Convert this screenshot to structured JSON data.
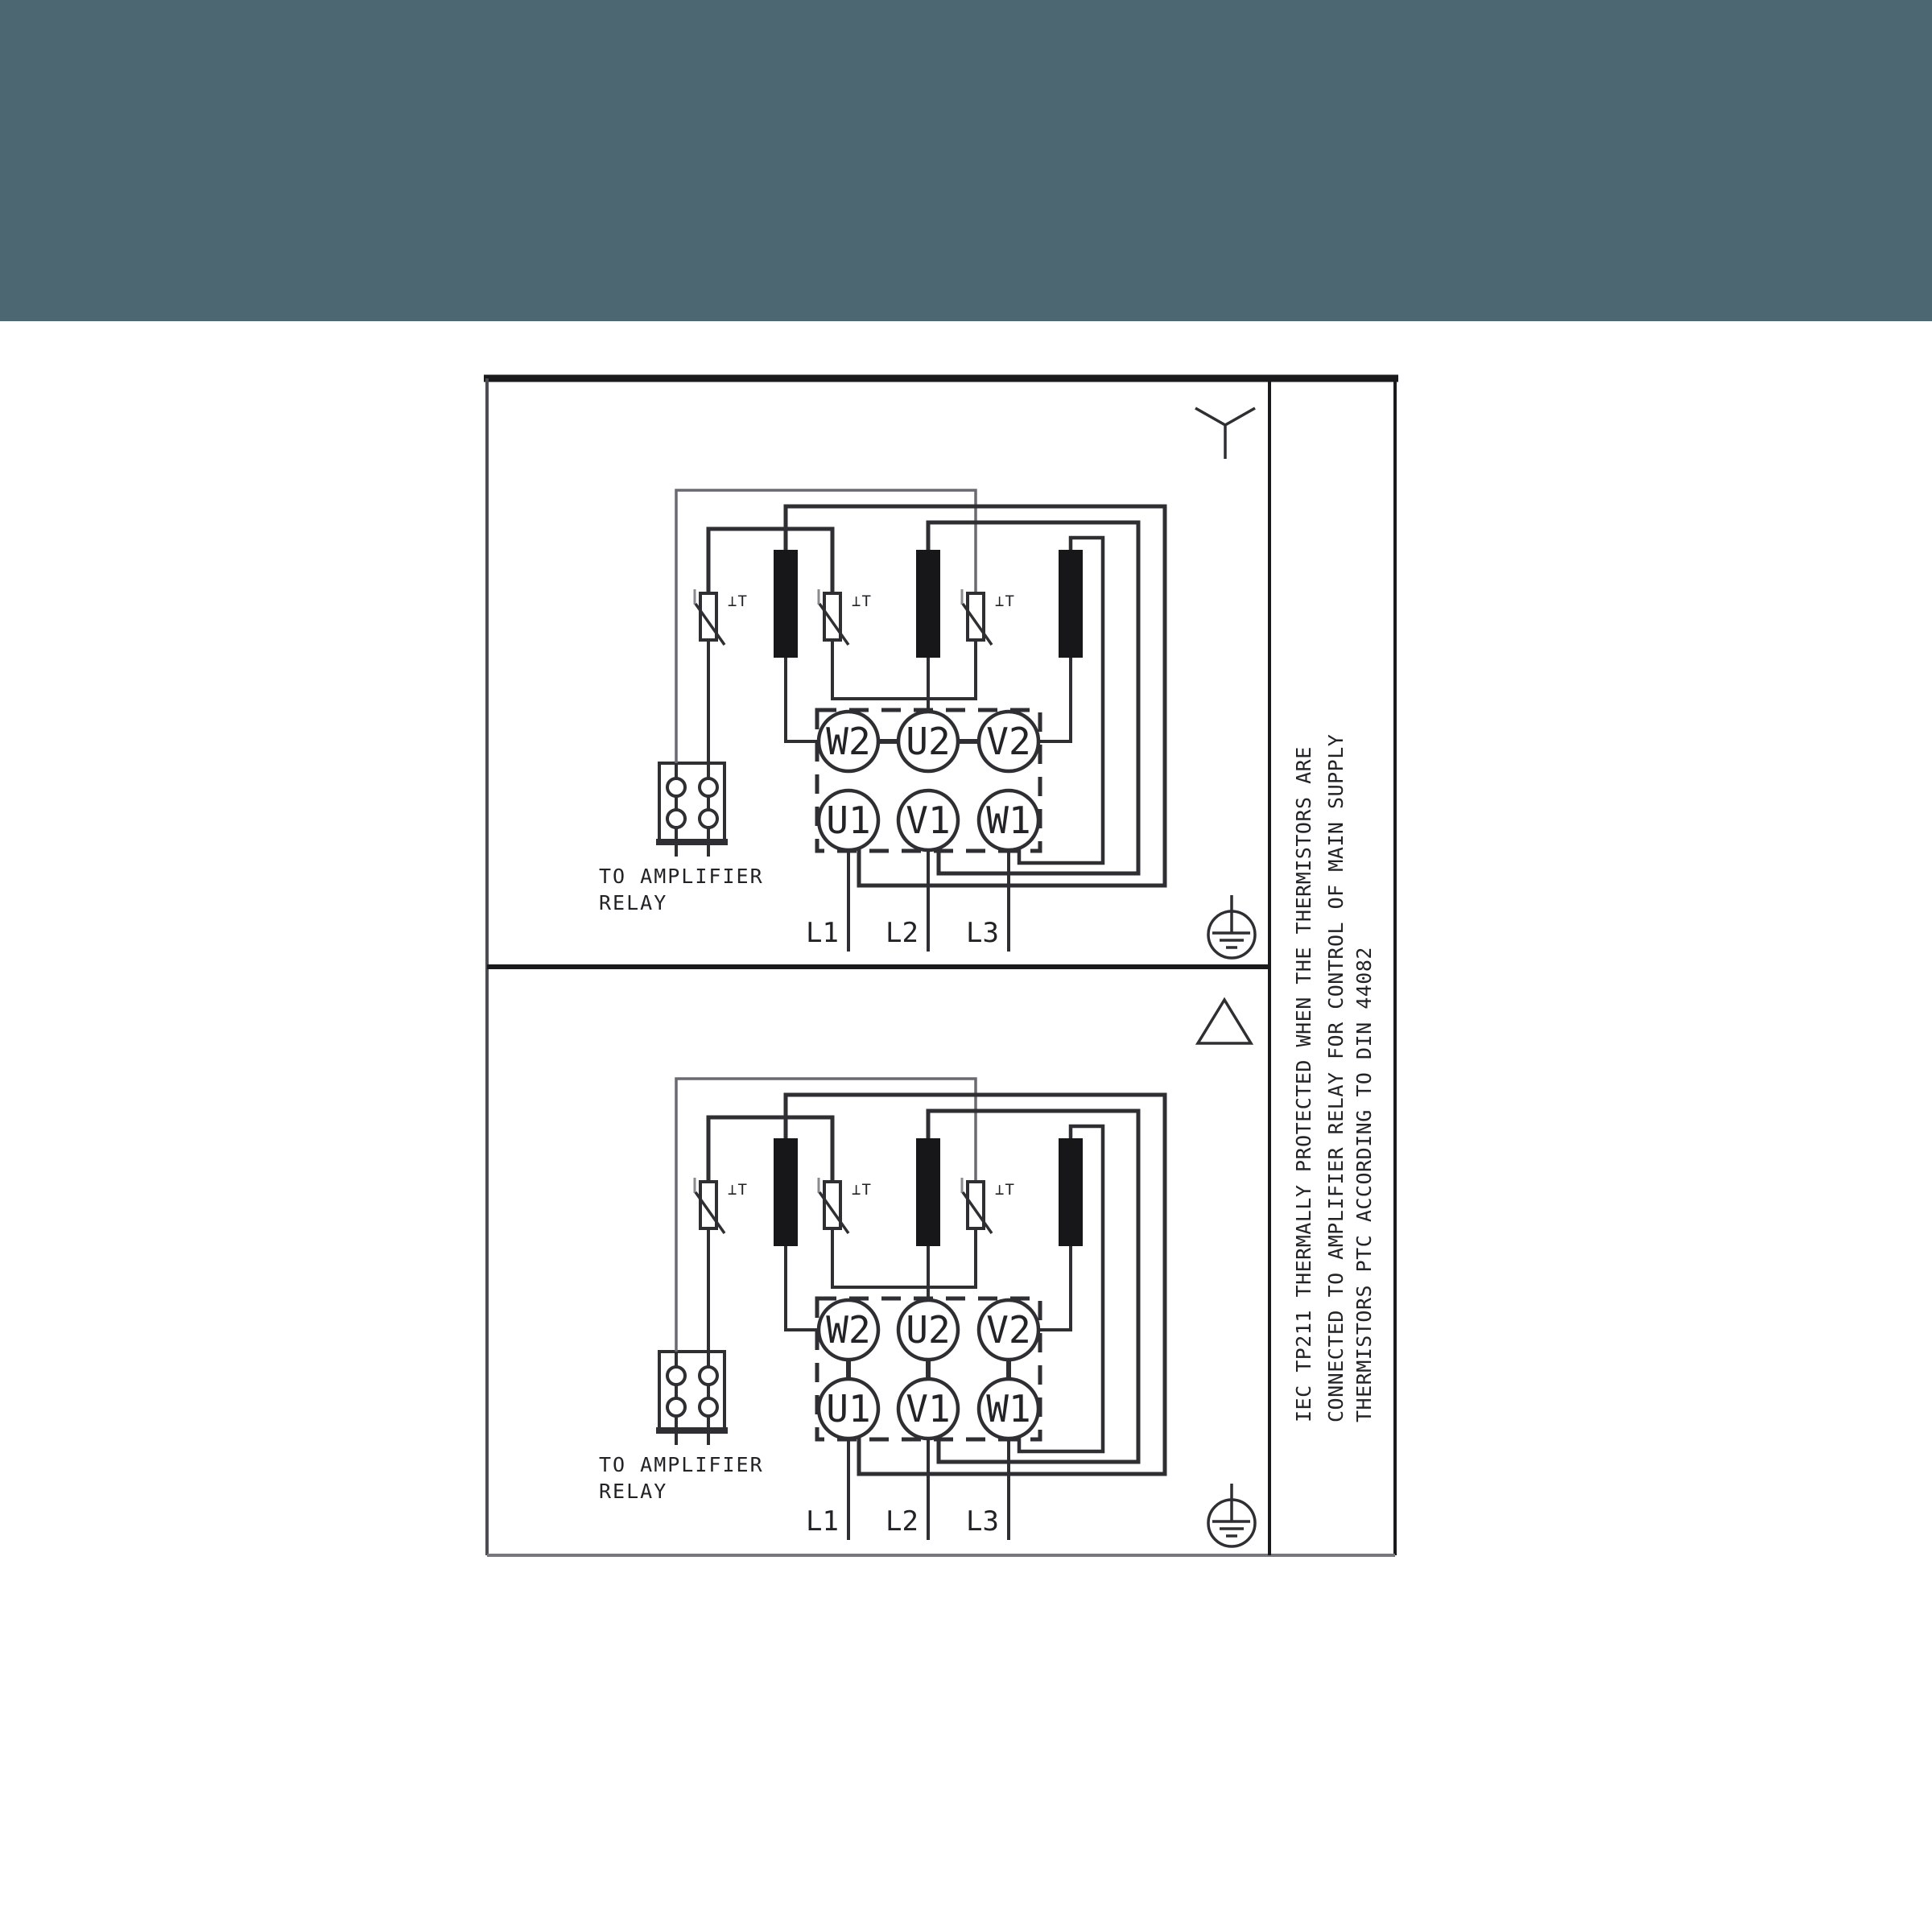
{
  "banner": {
    "background_color": "#4c6771"
  },
  "diagram": {
    "colors": {
      "line": "#2e2e33",
      "thin_line": "#6a6a72",
      "frame": "#1a1a1c",
      "bar_fill": "#17171a",
      "background": "#ffffff"
    },
    "sections": [
      {
        "connection": "star",
        "connection_icon": "star-icon",
        "terminals_top": [
          "W2",
          "U2",
          "V2"
        ],
        "terminals_bottom": [
          "U1",
          "V1",
          "W1"
        ],
        "supply_labels": [
          "L1",
          "L2",
          "L3"
        ],
        "relay_note": [
          "TO AMPLIFIER",
          "RELAY"
        ],
        "thermistor_label": "⊥T"
      },
      {
        "connection": "delta",
        "connection_icon": "delta-icon",
        "terminals_top": [
          "W2",
          "U2",
          "V2"
        ],
        "terminals_bottom": [
          "U1",
          "V1",
          "W1"
        ],
        "supply_labels": [
          "L1",
          "L2",
          "L3"
        ],
        "relay_note": [
          "TO AMPLIFIER",
          "RELAY"
        ],
        "thermistor_label": "⊥T"
      }
    ],
    "side_note_lines": [
      "IEC TP211 THERMALLY PROTECTED WHEN THE THERMISTORS ARE",
      "CONNECTED TO AMPLIFIER RELAY FOR CONTROL OF MAIN SUPPLY",
      "THERMISTORS PTC ACCORDING TO DIN 44082"
    ],
    "symbols": {
      "earth": "protective-earth-ground",
      "star": "star-connection",
      "delta": "delta-connection"
    }
  }
}
